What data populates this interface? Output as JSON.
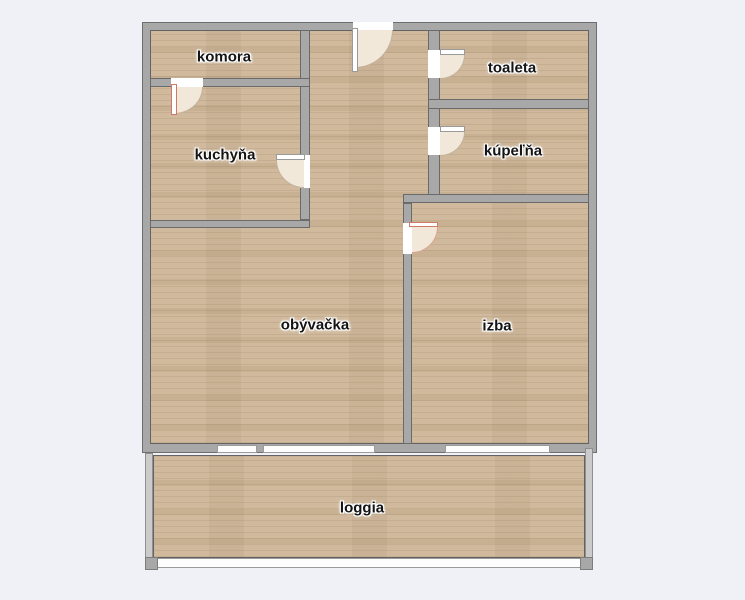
{
  "floorplan": {
    "rooms": [
      {
        "label": "komora"
      },
      {
        "label": "kuchyňa"
      },
      {
        "label": "toaleta"
      },
      {
        "label": "kúpeľňa"
      },
      {
        "label": "obývačka"
      },
      {
        "label": "izba"
      },
      {
        "label": "loggia"
      }
    ],
    "colors": {
      "background": "#eff1f6",
      "wall": "#a8a8a8",
      "wall_edge": "#6a6a6a",
      "floor_wood": "#d0b99c",
      "door_swing": "#f2e8da",
      "door_accent": "#cf7a68",
      "window": "#ffffff",
      "loggia_wall": "#cbcbcb"
    }
  }
}
